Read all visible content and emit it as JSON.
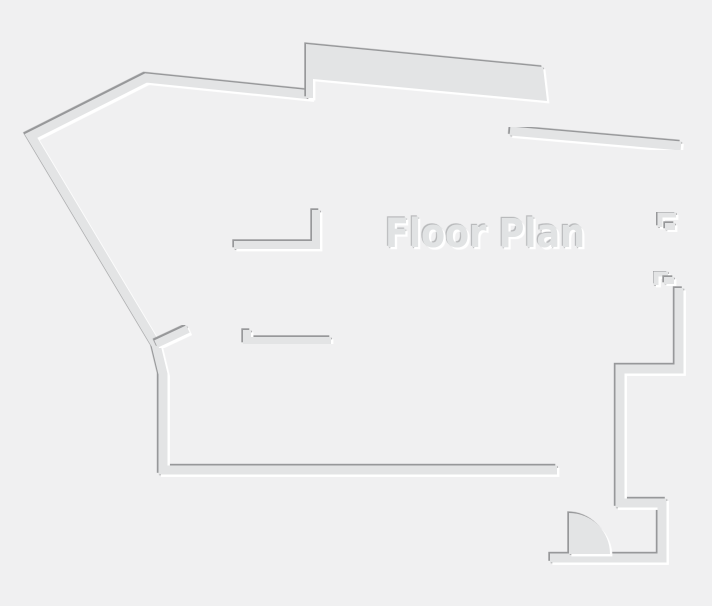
{
  "title": {
    "text": "Floor Plan"
  },
  "colors": {
    "background": "#f0f0f1",
    "wall_fill": "#e3e4e5",
    "shadow_edge": "#97989a",
    "highlight": "#ffffff",
    "title_fill": "#e1e3e4",
    "title_shadow_edge": "#a6a8aa"
  },
  "canvas": {
    "width": 712,
    "height": 606
  },
  "floor_plan": {
    "elements": [
      {
        "name": "room-divider-1",
        "type": "line",
        "w": 7,
        "pts": [
          [
            291,
            344
          ],
          [
            291,
            468
          ]
        ]
      },
      {
        "name": "room-divider-2",
        "type": "line",
        "w": 7,
        "pts": [
          [
            364,
            345
          ],
          [
            364,
            468
          ]
        ]
      },
      {
        "name": "room-divider-3-jamb",
        "type": "line",
        "w": 5,
        "pts": [
          [
            438,
            344
          ],
          [
            438,
            362
          ]
        ]
      },
      {
        "name": "room-divider-3",
        "type": "line",
        "w": 7,
        "pts": [
          [
            444,
            360
          ],
          [
            444,
            468
          ]
        ]
      },
      {
        "name": "entry-divider-wall",
        "type": "line",
        "w": 8,
        "pts": [
          [
            556,
            440
          ],
          [
            556,
            556
          ]
        ]
      },
      {
        "name": "outer-boundary-wall",
        "type": "polyline",
        "w": 9,
        "pts": [
          [
            312,
            95
          ],
          [
            146,
            78
          ],
          [
            31,
            136
          ],
          [
            156,
            345
          ],
          [
            163,
            374
          ],
          [
            163,
            470
          ],
          [
            557,
            470
          ]
        ]
      },
      {
        "name": "upper-slab-wall",
        "type": "polygon",
        "w": 0,
        "pts": [
          [
            306,
            44
          ],
          [
            543,
            67
          ],
          [
            547,
            101
          ],
          [
            313,
            79
          ],
          [
            313,
            98
          ],
          [
            306,
            98
          ]
        ]
      },
      {
        "name": "slab-connector-wall",
        "type": "line",
        "w": 12,
        "pts": [
          [
            512,
            97
          ],
          [
            512,
            130
          ]
        ]
      },
      {
        "name": "top-right-diagonal-wall",
        "type": "line",
        "w": 9,
        "pts": [
          [
            510,
            131
          ],
          [
            681,
            146
          ]
        ]
      },
      {
        "name": "right-wall-upper",
        "type": "line",
        "w": 9,
        "pts": [
          [
            679,
            143
          ],
          [
            679,
            218
          ]
        ]
      },
      {
        "name": "right-wall-middle",
        "type": "line",
        "w": 9,
        "pts": [
          [
            679,
            230
          ],
          [
            679,
            275
          ]
        ]
      },
      {
        "name": "right-opening-1-stub",
        "type": "polyline",
        "w": 5,
        "pts": [
          [
            676,
            215
          ],
          [
            660,
            215
          ],
          [
            660,
            227
          ]
        ]
      },
      {
        "name": "right-opening-1-block",
        "type": "polygon",
        "w": 0,
        "pts": [
          [
            665,
            223
          ],
          [
            675,
            223
          ],
          [
            675,
            230
          ],
          [
            665,
            230
          ]
        ]
      },
      {
        "name": "right-opening-2-stub",
        "type": "polyline",
        "w": 5,
        "pts": [
          [
            668,
            274
          ],
          [
            656,
            274
          ],
          [
            656,
            285
          ]
        ]
      },
      {
        "name": "right-opening-2-block",
        "type": "polygon",
        "w": 0,
        "pts": [
          [
            664,
            277
          ],
          [
            674,
            277
          ],
          [
            674,
            284
          ],
          [
            664,
            284
          ]
        ]
      },
      {
        "name": "right-wall-lower-steps",
        "type": "polyline",
        "w": 9,
        "pts": [
          [
            679,
            288
          ],
          [
            679,
            369
          ],
          [
            620,
            369
          ],
          [
            620,
            503
          ],
          [
            662,
            503
          ],
          [
            662,
            558
          ],
          [
            550,
            558
          ]
        ]
      },
      {
        "name": "strip-top-wall-a",
        "type": "line",
        "w": 8,
        "pts": [
          [
            191,
            341
          ],
          [
            216,
            341
          ]
        ]
      },
      {
        "name": "strip-top-wall-b",
        "type": "polyline",
        "w": 8,
        "pts": [
          [
            247,
            330
          ],
          [
            247,
            341
          ],
          [
            331,
            341
          ]
        ]
      },
      {
        "name": "strip-top-wall-c",
        "type": "line",
        "w": 9,
        "pts": [
          [
            356,
            341
          ],
          [
            376,
            341
          ]
        ]
      },
      {
        "name": "strip-top-wall-d",
        "type": "line",
        "w": 9,
        "pts": [
          [
            403,
            341
          ],
          [
            466,
            341
          ]
        ]
      },
      {
        "name": "left-door-leaf",
        "type": "line",
        "w": 8,
        "pts": [
          [
            156,
            344
          ],
          [
            188,
            329
          ]
        ]
      },
      {
        "name": "closet-wall",
        "type": "polyline",
        "w": 8,
        "pts": [
          [
            234,
            245
          ],
          [
            316,
            245
          ],
          [
            316,
            210
          ]
        ]
      },
      {
        "name": "closet-stub-1",
        "type": "line",
        "w": 7,
        "pts": [
          [
            251,
            250
          ],
          [
            251,
            302
          ]
        ]
      },
      {
        "name": "closet-stub-2",
        "type": "line",
        "w": 7,
        "pts": [
          [
            296,
            250
          ],
          [
            296,
            293
          ]
        ]
      },
      {
        "name": "closet-bar",
        "type": "line",
        "w": 8,
        "pts": [
          [
            302,
            290
          ],
          [
            321,
            290
          ]
        ]
      },
      {
        "name": "corridor-wall",
        "type": "line",
        "w": 17,
        "pts": [
          [
            223,
            90
          ],
          [
            223,
            281
          ]
        ]
      },
      {
        "name": "entry-door-swing",
        "type": "path",
        "w": 0,
        "d": "M 569,554 L 569,513 A 41,41 0 0 1 610,554 Z"
      }
    ]
  }
}
